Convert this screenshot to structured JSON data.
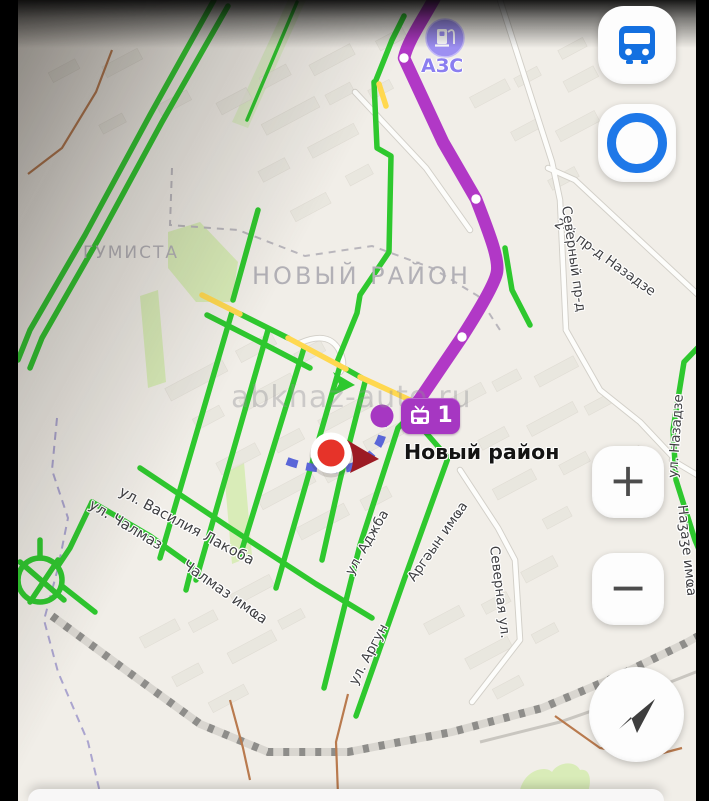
{
  "colors": {
    "traffic_green": "#2ec82e",
    "traffic_yellow": "#ffd84f",
    "route_purple": "#b138c6",
    "stop_purple": "#a637c2",
    "walk_blue": "#5a66d8",
    "accent_blue": "#1470e0",
    "pin_red": "#e63329",
    "pin_arrow_red": "#9c1b24",
    "poi_purple": "#9d8ff2"
  },
  "map": {
    "watermark": "abkhaz-auto.ru",
    "district_labels": [
      {
        "text": "ГУМИСТА"
      },
      {
        "text": "НОВЫЙ РАЙОН"
      }
    ],
    "street_labels": [
      {
        "text": "2-й пр-д Назадзе"
      },
      {
        "text": "Северный пр-д"
      },
      {
        "text": "ул. Василия Лакоба"
      },
      {
        "text": "ул. Чалмаз"
      },
      {
        "text": "Чалмаз имҩа"
      },
      {
        "text": "ул. Аджба"
      },
      {
        "text": "ул. Аргун"
      },
      {
        "text": "Аргәын имҩа"
      },
      {
        "text": "Северная ул."
      },
      {
        "text": "ул. Назадзе"
      },
      {
        "text": "Наӡаӡе имҩа"
      }
    ],
    "poi": {
      "gas_station_label": "АЗС"
    },
    "transit_stop": {
      "name": "Новый район",
      "route_number": "1"
    }
  },
  "controls": {
    "zoom_in_label": "+",
    "zoom_out_label": "−"
  }
}
